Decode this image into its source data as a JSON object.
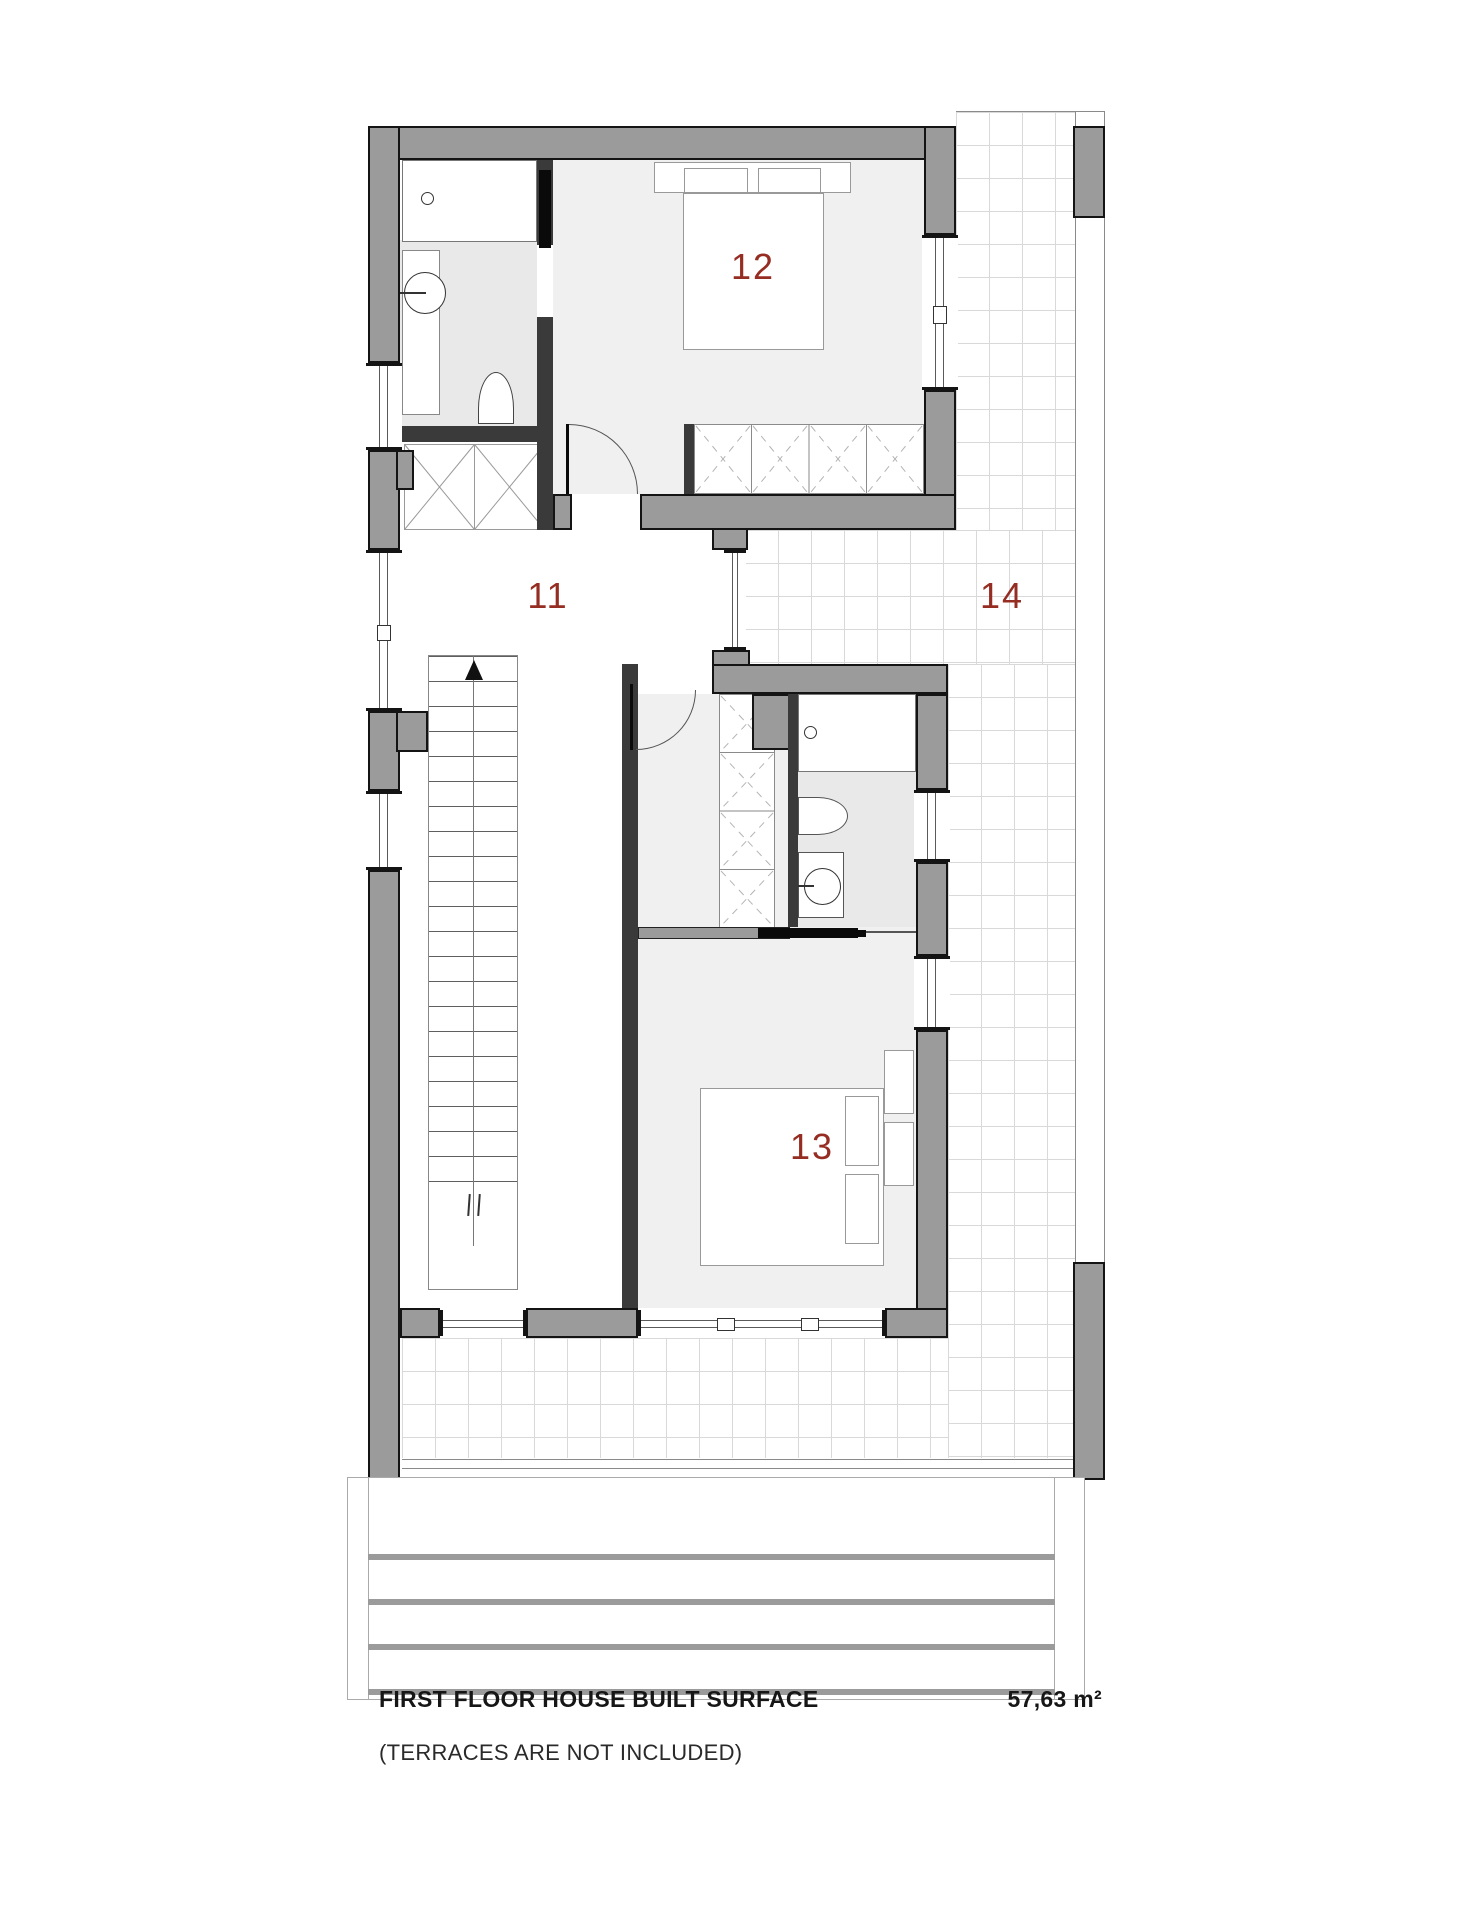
{
  "colors": {
    "room_label": "#962d22",
    "wall_fill": "#9b9b9b",
    "wall_outline": "#141414",
    "floor_light": "#f0f0f0",
    "floor_mid": "#e9e9e9",
    "tile_line": "#d9d9d9"
  },
  "rooms": {
    "hall": {
      "label": "11"
    },
    "bedroom_12": {
      "label": "12"
    },
    "bedroom_13": {
      "label": "13"
    },
    "terrace": {
      "label": "14"
    }
  },
  "footer": {
    "title": "FIRST FLOOR HOUSE BUILT SURFACE",
    "subtitle": "(TERRACES ARE NOT INCLUDED)",
    "area_value": "57,63 m²"
  }
}
